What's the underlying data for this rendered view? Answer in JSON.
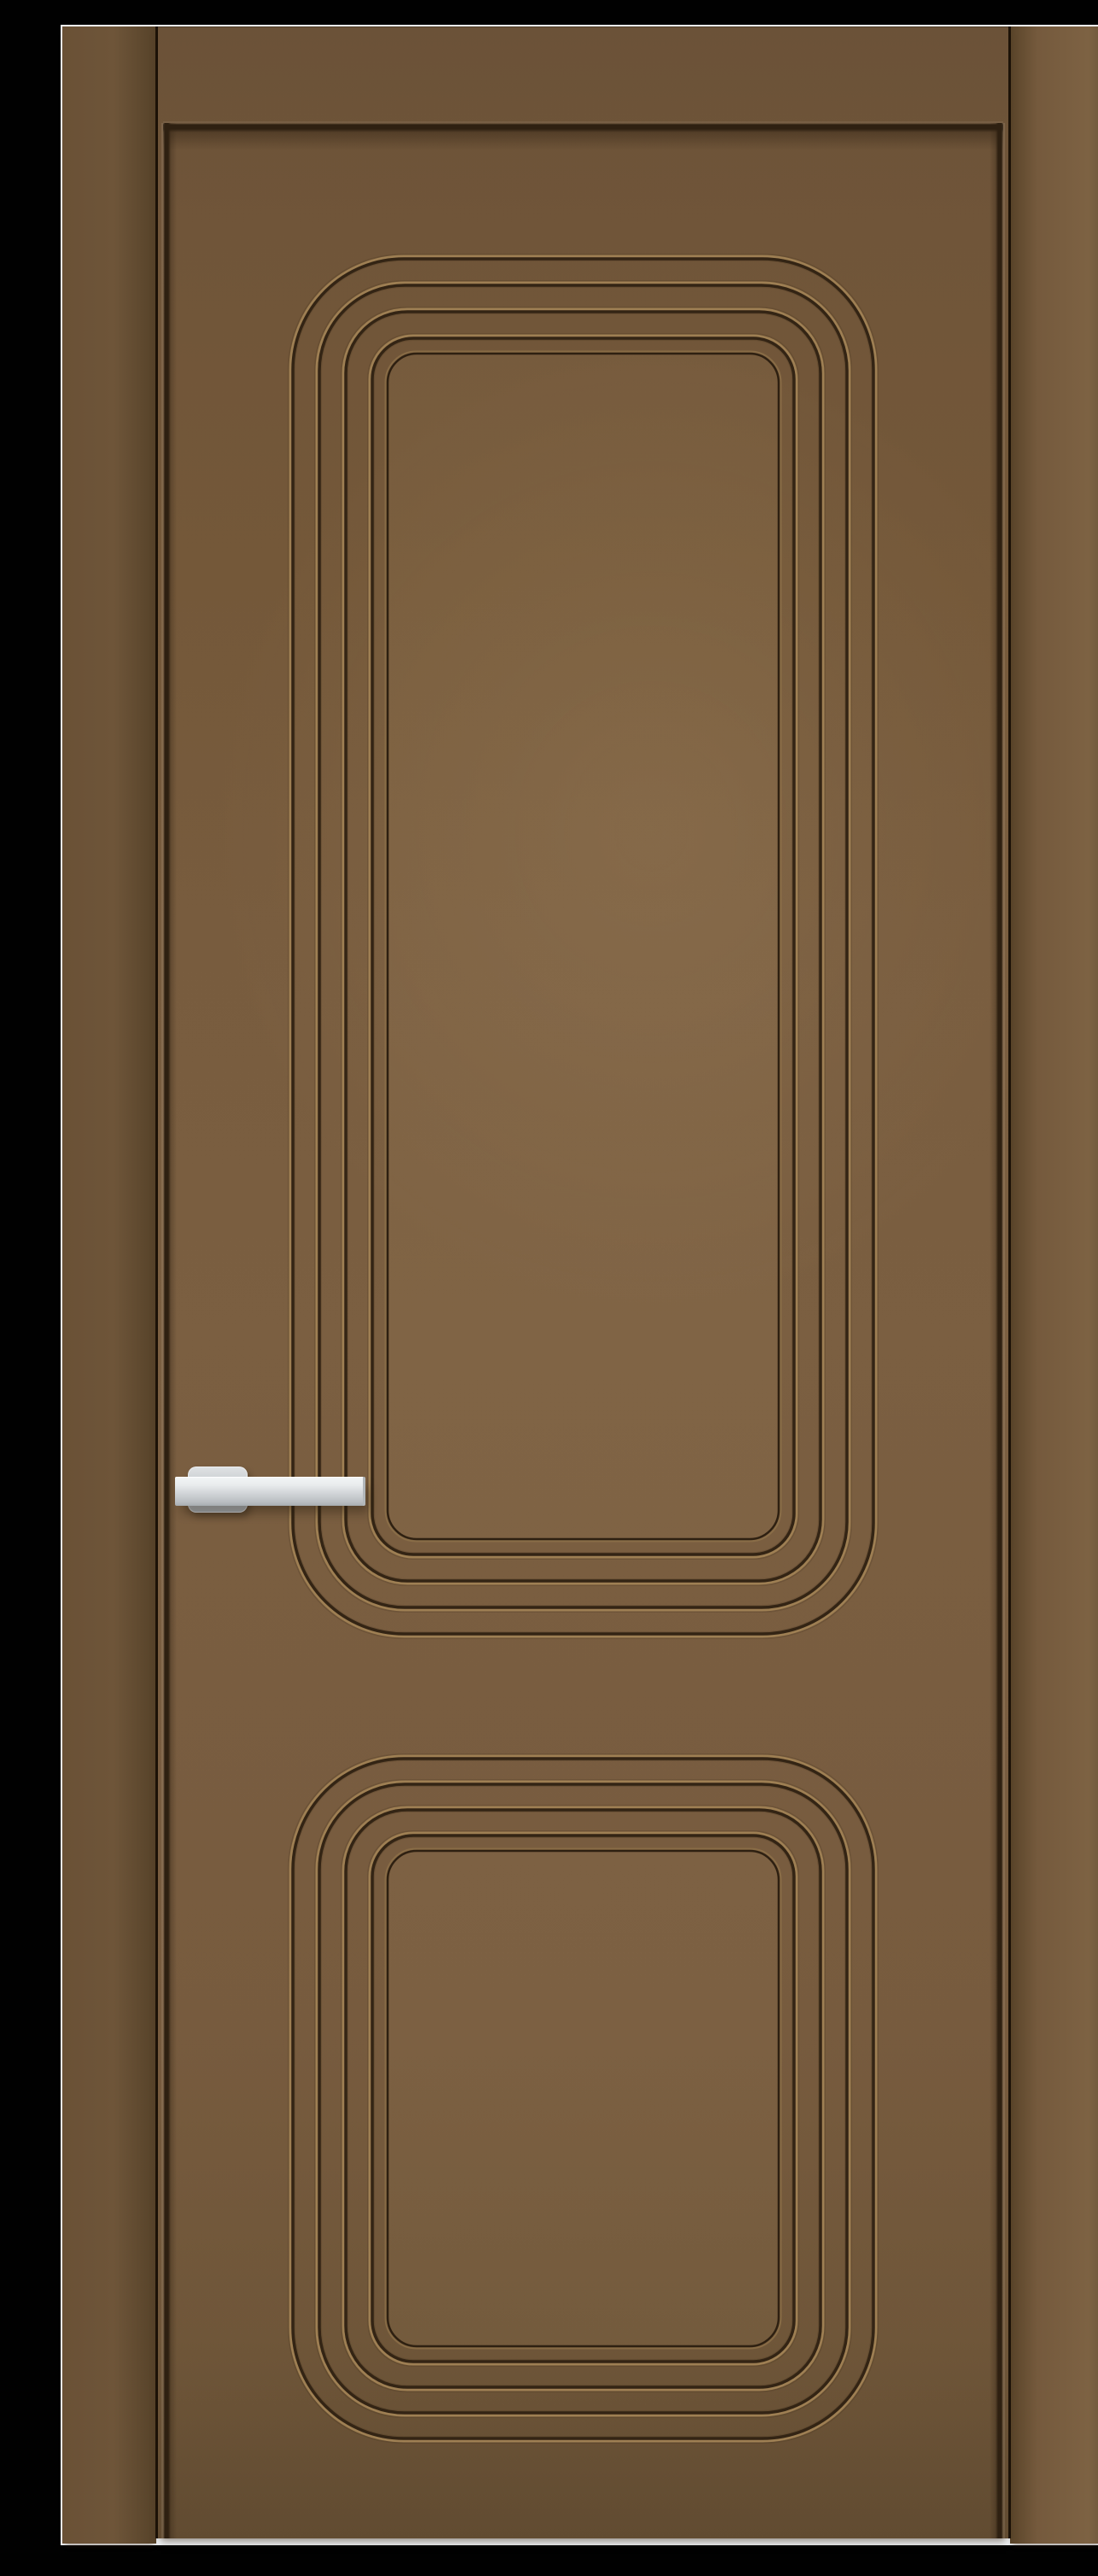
{
  "scene": {
    "description": "Product photo of a bronze-brown interior door with two recessed panels framed by four concentric raised mouldings each, a satin chrome lever handle on the left stile, door frame jambs on both sides, a white backdrop and black margins around the photo.",
    "subject": "interior door",
    "finish": "matte bronze-brown enamel",
    "handle": {
      "type": "lever",
      "finish": "satin chrome",
      "side": "left"
    },
    "panels": [
      {
        "name": "upper-panel",
        "moulding_rings": 4,
        "shape": "rounded-rectangle"
      },
      {
        "name": "lower-panel",
        "moulding_rings": 4,
        "shape": "rounded-rectangle"
      }
    ],
    "frame": {
      "left_jamb": true,
      "right_jamb": true
    },
    "backdrop": "white",
    "border": "black letterbox"
  },
  "colors": {
    "bg_black": "#010101",
    "bg_white": "#f3f6f9",
    "jamb_left_a": "#6a5136",
    "jamb_left_b": "#6e5539",
    "jamb_left_edge": "#564229",
    "jamb_right_a": "#594429",
    "jamb_right_b": "#755a3d",
    "jamb_right_c": "#7d6243",
    "leaf_top": "#6b5238",
    "leaf_upper": "#745839",
    "leaf_mid": "#7b5f41",
    "leaf_lower": "#775b3e",
    "leaf_bottom": "#614b31",
    "gap_dark": "#1c1207",
    "groove_dark": "#2e2011",
    "ridge_hi": "#9e7f53",
    "ridge_dark": "#332414",
    "ridge_soft": "#46331d",
    "panel_edge_hi": "#8d7149",
    "handle_hi": "#f3f5f6",
    "handle_a": "#e9eced",
    "handle_b": "#c7cbce",
    "handle_c": "#a7adb1",
    "rosette_a": "#dfe2e4",
    "rosette_b": "#b4babe"
  }
}
